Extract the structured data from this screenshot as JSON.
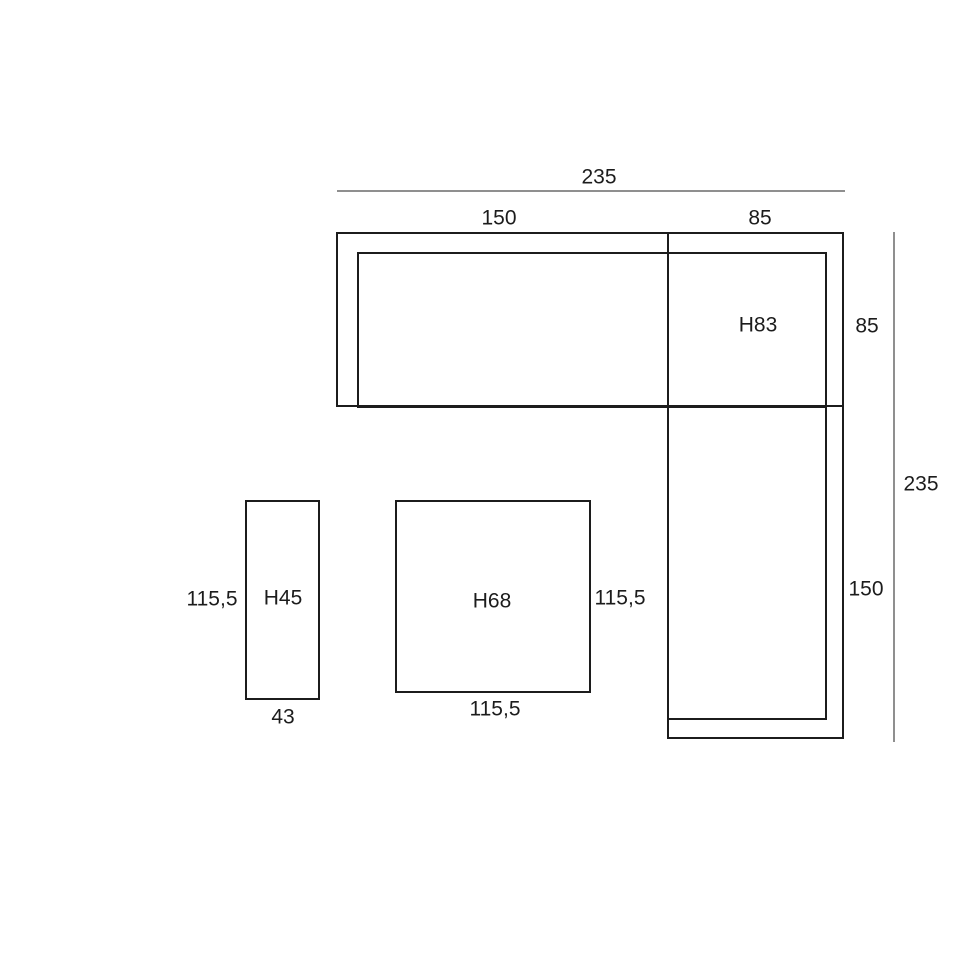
{
  "page": {
    "background": "#ffffff"
  },
  "palette": {
    "outline_color": "#1c1c1c",
    "dimension_line_color": "#8f8f8f",
    "text_color": "#1c1c1c"
  },
  "sofa": {
    "total_width": "235",
    "left_section_width": "150",
    "corner_section_width": "85",
    "corner_section_depth": "85",
    "total_depth": "235",
    "chaise_length": "150",
    "height_label": "H83"
  },
  "bench": {
    "height_label": "H45",
    "depth": "115,5",
    "width": "43"
  },
  "table": {
    "height_label": "H68",
    "depth": "115,5",
    "width": "115,5"
  }
}
